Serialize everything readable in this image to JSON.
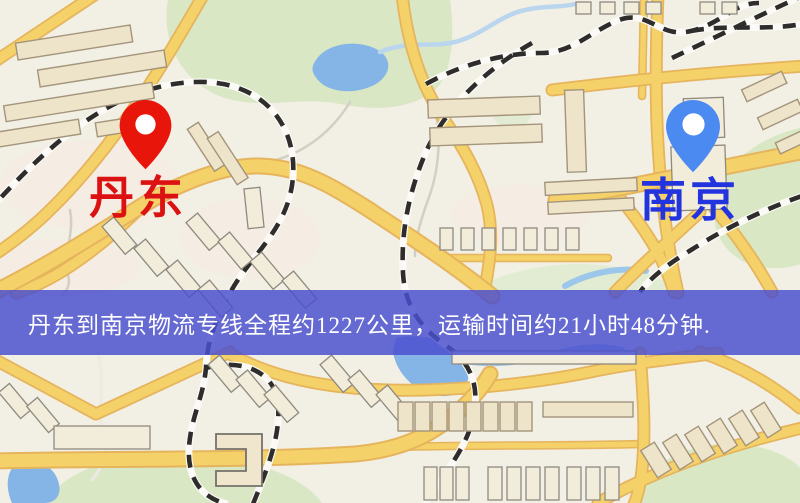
{
  "banner": {
    "text": "丹东到南京物流专线全程约1227公里，运输时间约21小时48分钟."
  },
  "markers": {
    "origin": {
      "label": "丹东",
      "icon": "red-location-pin-icon"
    },
    "destination": {
      "label": "南京",
      "icon": "blue-location-pin-icon"
    }
  },
  "route": {
    "from": "丹东",
    "to": "南京",
    "service": "物流专线",
    "distance_text": "约1227公里",
    "duration_text": "约21小时48分钟"
  },
  "colors": {
    "map-bg": "#f2efe4",
    "park": "#d9e7c4",
    "park-light": "#e2ecd2",
    "water": "#84b5e6",
    "water-light": "#b9d6ee",
    "road-fill": "#f5d169",
    "road-casing": "#e5b45c",
    "building-fill": "#eee4c9",
    "building-stroke": "#a3947b",
    "rail-dark": "#2e2d2b",
    "banner-bg": "rgba(74,79,206,0.84)",
    "banner-text": "#ffffff",
    "origin-pin": "#e8150b",
    "origin-label": "#dc1111",
    "dest-pin": "#4b8af0",
    "dest-label": "#2334df"
  }
}
